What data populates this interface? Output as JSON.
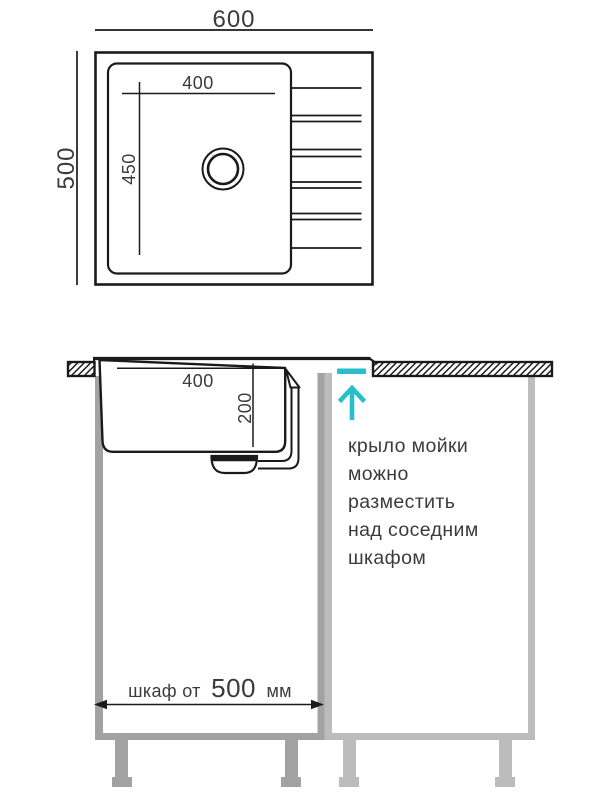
{
  "colors": {
    "line": "#1a1a1a",
    "text": "#3b3b3b",
    "accent": "#29bfca",
    "cabinet_left": "#a2a2a2",
    "cabinet_right": "#bcbcbc"
  },
  "top_view": {
    "overall_width_mm": "600",
    "overall_depth_mm": "500",
    "bowl_width_mm": "400",
    "bowl_depth_mm": "450"
  },
  "section_view": {
    "bowl_width_mm": "400",
    "bowl_depth_mm": "200",
    "note_lines": [
      "крыло мойки",
      "можно",
      "разместить",
      "над соседним",
      "шкафом"
    ],
    "cabinet_label_prefix": "шкаф от",
    "cabinet_label_value": "500",
    "cabinet_label_unit": "мм"
  }
}
